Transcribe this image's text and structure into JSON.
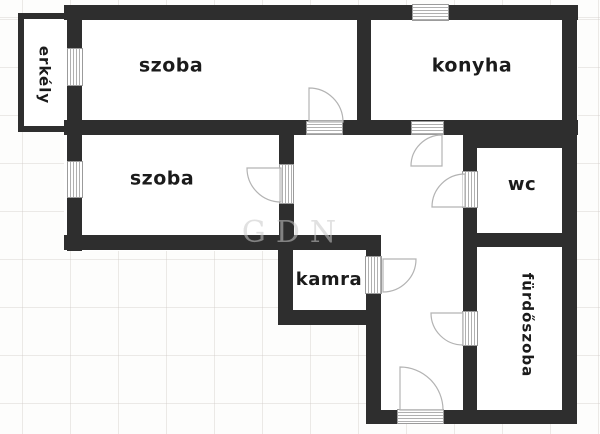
{
  "plan": {
    "title": "apartment-floor-plan",
    "watermark": "GDN",
    "rooms": [
      {
        "id": "szoba-1",
        "label": "szoba"
      },
      {
        "id": "konyha",
        "label": "konyha"
      },
      {
        "id": "szoba-2",
        "label": "szoba"
      },
      {
        "id": "wc",
        "label": "wc"
      },
      {
        "id": "kamra",
        "label": "kamra"
      },
      {
        "id": "erkely",
        "label": "erkély"
      },
      {
        "id": "furdoszoba",
        "label": "fürdőszoba"
      }
    ],
    "symbols": {
      "door_swing_icon": "quarter-circle-arc",
      "opening_icon": "lined-frame (door/window)"
    },
    "colors": {
      "wall": "#2e2e2e",
      "room_fill": "#ffffff",
      "label_text": "#1b1b1b",
      "watermark": "#c8c8c8",
      "grid_line": "#ece9e6",
      "door_arc": "#b3b3b3"
    }
  }
}
